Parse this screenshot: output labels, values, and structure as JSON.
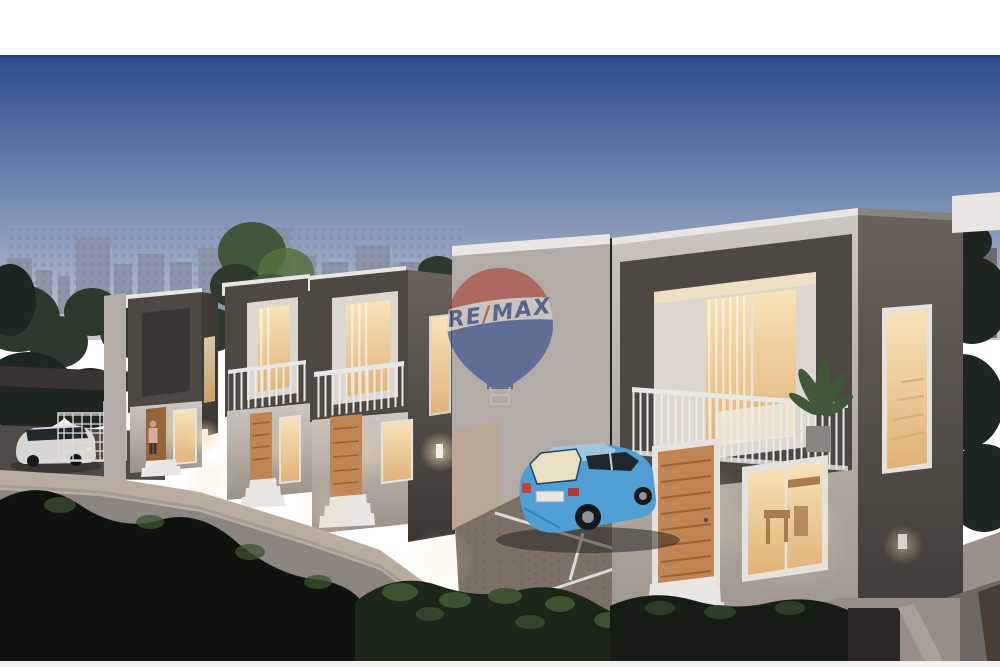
{
  "description": "Dusk 3D architectural render: a row of four modern two-storey townhouses with dark balcony frames and warmly lit interiors, a gated driveway with a white car and one pedestrian on the left, a blue hatchback parked beside the nearest house, a distant city skyline and trees behind, dark shrubs in the foreground, and a translucent RE/MAX hot-air-balloon watermark in the centre.",
  "watermark": {
    "brand": "RE/MAX",
    "re": "RE",
    "slash": "/",
    "max": "MAX"
  },
  "scene": {
    "townhouses": 4,
    "cars": [
      "blue hatchback",
      "white car"
    ],
    "people": 1,
    "time_of_day": "dusk"
  },
  "palette": {
    "sky_top": "#2f4b88",
    "sky_mid": "#5d77a8",
    "sky_low": "#9aa9c2",
    "sky_horizon": "#cbc6c8",
    "skyline": "#8a93a7",
    "skyline_window": "#6a7590",
    "tower_right": "#6b616b",
    "tree_dark": "#1d261f",
    "tree_mid": "#2c392c",
    "tree_green": "#41573a",
    "tree_light": "#55713f",
    "parapet": "#e8e5e2",
    "box_dark": "#4e4843",
    "channel_dark": "#3f3a36",
    "wall_light": "#cdc7c1",
    "wall_mid": "#b3aca6",
    "wall_dim": "#9b9189",
    "wall_shadow": "#6a635d",
    "box_darker": "#3c3733",
    "recess": "#ddd6cf",
    "glass_warm_hi": "#f6e3b8",
    "glass_warm_lo": "#e2b277",
    "wood": "#c08552",
    "wood_dark": "#95663a",
    "railing": "#e9e7e5",
    "frame_white": "#e5e1dc",
    "walkway": "#b9ab9e",
    "platform_wall": "#8d8680",
    "pavement": "#7d7166",
    "road": "#504b47",
    "car_blue": "#4f9fd4",
    "car_blue_dark": "#2f76a8",
    "car_glass": "#20262b",
    "white_car": "#d7d6d3",
    "person_pink": "#d9a8a0",
    "balloon_red": "#a84038",
    "balloon_blue": "#2d4a8a",
    "balloon_band": "#d8d3d1",
    "logo_navy": "#1d3a77",
    "logo_red": "#c0392e",
    "glow_warm": "#f7dfae",
    "shrub_black": "#0f130e",
    "shrub_green": "#1c2619",
    "shrub_leaf": "#3c5230"
  }
}
